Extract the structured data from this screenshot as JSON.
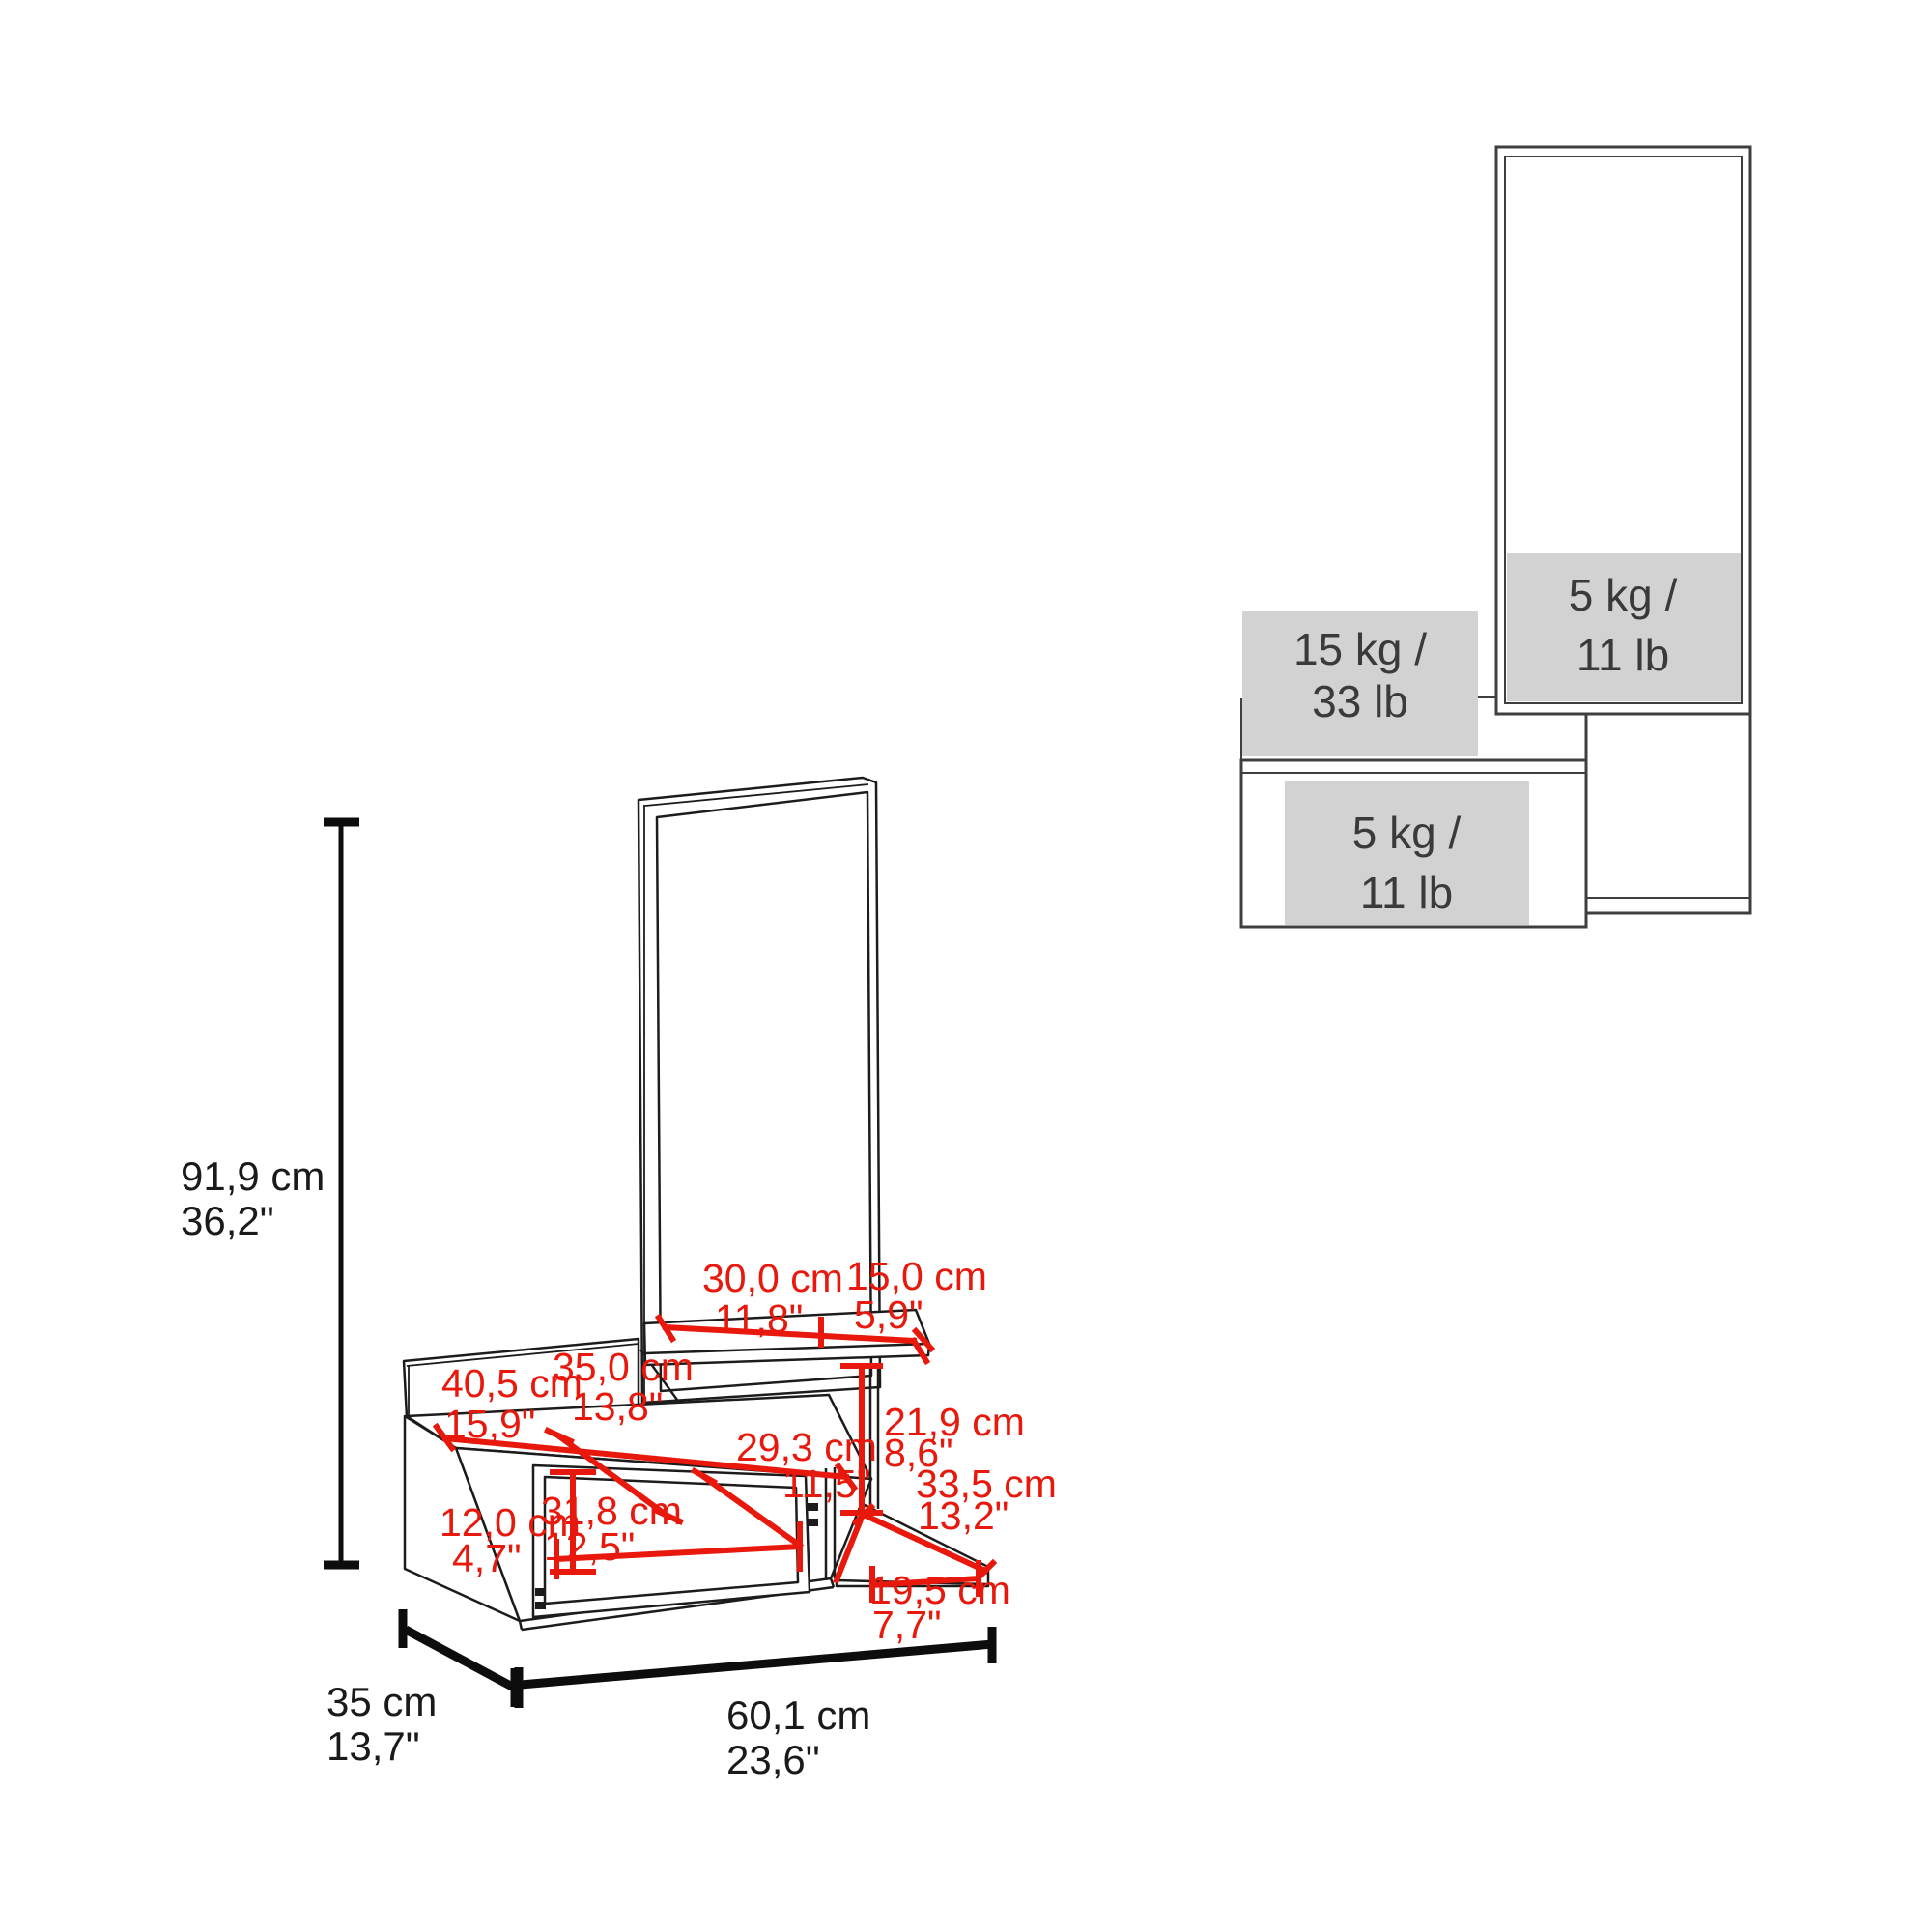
{
  "colors": {
    "dimension_red": "#e8180c",
    "line_dark": "#1c1c1c",
    "capacity_fill": "#d2d2d2",
    "capacity_text": "#3a3a3a"
  },
  "main_view": {
    "height": {
      "cm": "91,9 cm",
      "inch": "36,2\""
    },
    "depth": {
      "cm": "35 cm",
      "inch": "13,7\""
    },
    "width": {
      "cm": "60,1 cm",
      "inch": "23,6\""
    },
    "red_dims": {
      "shelf_left": {
        "cm": "30,0 cm",
        "inch": "11,8\""
      },
      "shelf_right": {
        "cm": "15,0 cm",
        "inch": "5,9\""
      },
      "panel_width": {
        "cm": "40,5 cm",
        "inch": "15,9\""
      },
      "mirror_width": {
        "cm": "35,0 cm",
        "inch": "13,8\""
      },
      "open_height": {
        "cm": "21,9 cm",
        "inch": "8,6\""
      },
      "niche_diag": {
        "cm": "29,3 cm",
        "inch": "11,5\""
      },
      "shelf_depth": {
        "cm": "33,5 cm",
        "inch": "13,2\""
      },
      "niche_height": {
        "cm": "12,0 cm",
        "inch": "4,7\""
      },
      "niche_width": {
        "cm": "31,8 cm",
        "inch": "12,5\""
      },
      "shelf_width": {
        "cm": "19,5 cm",
        "inch": "7,7\""
      }
    }
  },
  "capacity_view": {
    "mirror_shelf": {
      "line1": "5 kg /",
      "line2": "11 lb"
    },
    "top_surface": {
      "line1": "15 kg /",
      "line2": "33 lb"
    },
    "drawer": {
      "line1": "5 kg /",
      "line2": "11 lb"
    }
  }
}
